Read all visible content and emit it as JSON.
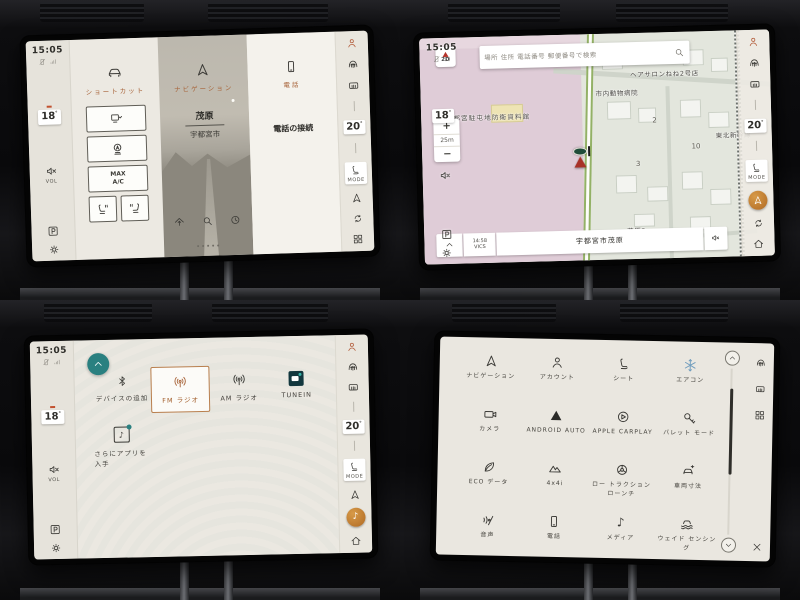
{
  "colors": {
    "accent": "#a8643a",
    "teal": "#2a8080",
    "active_orange": "#b06a24",
    "lr_green": "#1f4c39",
    "map_pink": "#dfccd7"
  },
  "sidebar": {
    "time": "15:05",
    "temp_driver": "18",
    "temp_passenger": "20",
    "deg": "°",
    "vol_label": "VOL",
    "mode_label": "MODE"
  },
  "q1": {
    "shortcuts_title": "ショートカット",
    "max_ac_line1": "MAX",
    "max_ac_line2": "A/C",
    "nav_title": "ナビゲーション",
    "nav_dest": "茂原",
    "nav_city": "宇都宮市",
    "phone_title": "電話",
    "phone_status": "電話の接続"
  },
  "q2": {
    "search_placeholder": "場所 住所 電話番号 郵便番号で検索",
    "compass_mode": "2D",
    "zoom_in": "+",
    "zoom_scale": "25m",
    "zoom_out": "−",
    "vics_time": "14:58",
    "vics_label": "VICS",
    "current_street": "宇都宮市茂原",
    "poi_museum": "宇都宮駐屯地防衛資料館",
    "poi_salon": "ヘアサロンねね2号店",
    "poi_hospital": "市内動物病院",
    "poi_rail": "東北新幹線",
    "poi_district": "茂原2",
    "block_a": "2",
    "block_b": "3",
    "block_c": "10"
  },
  "q3": {
    "src_bluetooth": "デバイスの追加",
    "src_fm": "FM ラジオ",
    "src_am": "AM ラジオ",
    "src_tunein": "TUNEIN",
    "more_apps": "さらにアプリを入手",
    "note_glyph": "♪"
  },
  "q4": {
    "apps": [
      {
        "label": "ナビゲーション"
      },
      {
        "label": "アカウント"
      },
      {
        "label": "シート"
      },
      {
        "label": "エアコン"
      },
      {
        "label": "カメラ"
      },
      {
        "label": "ANDROID AUTO"
      },
      {
        "label": "APPLE CARPLAY"
      },
      {
        "label": "バレット モード"
      },
      {
        "label": "ECO データ"
      },
      {
        "label": "4x4i"
      },
      {
        "label": "ロー トラクション ローンチ"
      },
      {
        "label": "車両寸法"
      },
      {
        "label": "音声"
      },
      {
        "label": "電話"
      },
      {
        "label": "メディア"
      },
      {
        "label": "ウェイド センシング"
      }
    ]
  }
}
